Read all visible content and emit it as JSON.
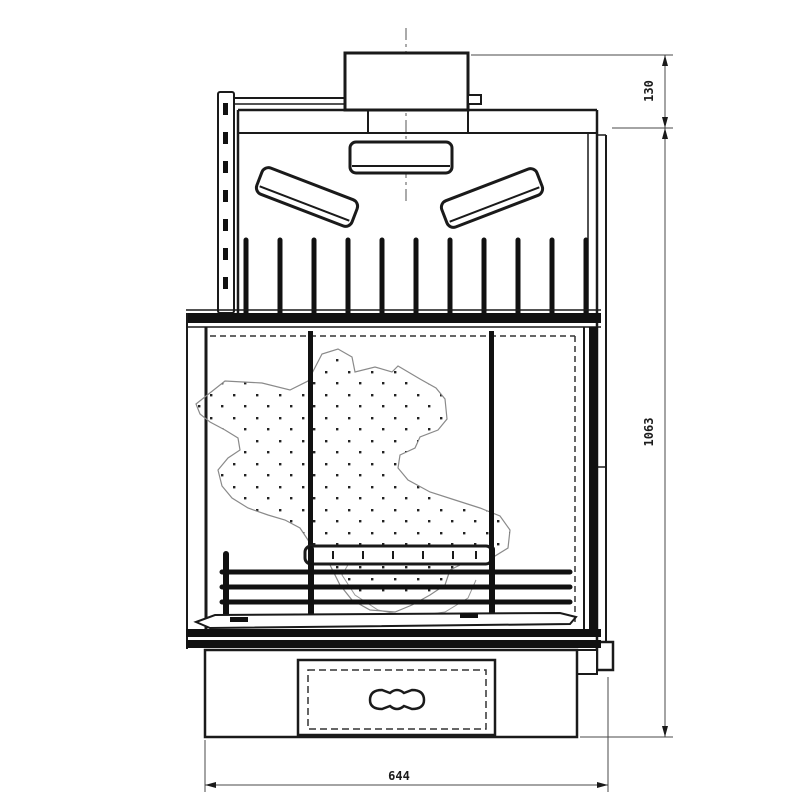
{
  "drawing": {
    "dimensions": {
      "flue_height": "130",
      "total_height": "1063",
      "base_width": "644"
    },
    "colors": {
      "line": "#1a1a1a",
      "dimension_line": "#4a4a4a",
      "background": "#ffffff",
      "stipple_dot": "#222222",
      "fireback_outline": "#8a8a8a"
    }
  }
}
